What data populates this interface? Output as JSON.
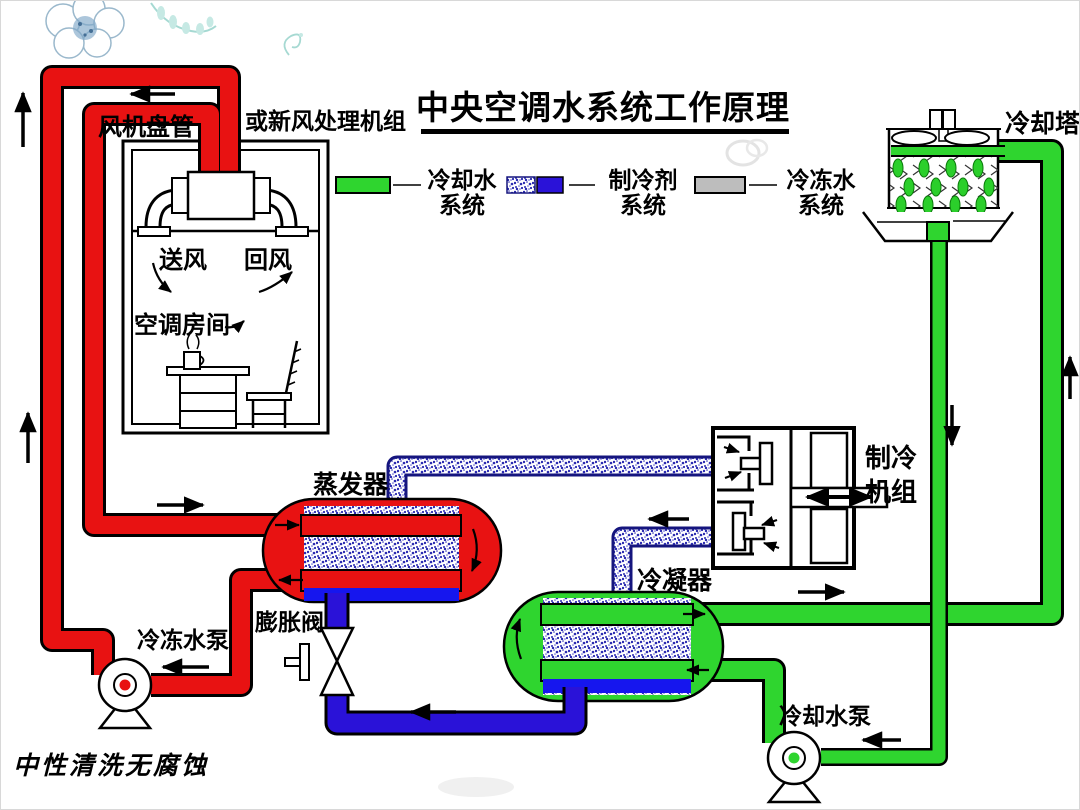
{
  "title": "中央空调水系统工作原理",
  "legend": {
    "items": [
      {
        "line1": "冷却水",
        "line2": "系统",
        "swatch": "green-bar"
      },
      {
        "line1": "制冷剂",
        "line2": "系统",
        "swatch": "speckle-and-blue-bar"
      },
      {
        "line1": "冷冻水",
        "line2": "系统",
        "swatch": "gray-bar"
      }
    ]
  },
  "labels": {
    "fan_coil": "风机盘管",
    "ahu_alt": "或新风处理机组",
    "supply_air": "送风",
    "return_air": "回风",
    "room": "空调房间",
    "evaporator": "蒸发器",
    "expansion_valve": "膨胀阀",
    "chilled_water_pump": "冷冻水泵",
    "condenser": "冷凝器",
    "chiller_line1": "制冷",
    "chiller_line2": "机组",
    "cooling_tower": "冷却塔",
    "cooling_water_pump": "冷却水泵"
  },
  "footer": {
    "calligraphy": "中性清洗无腐蚀"
  },
  "colors": {
    "chilled_water_pipe": "#E81212",
    "cooling_water_pipe": "#2FD52F",
    "refrigerant_liquid": "#2A12D8",
    "tank_bottom_blue": "#1616EE",
    "legend_gray": "#BDBDBD",
    "droplet_green": "#2BCF2B"
  }
}
